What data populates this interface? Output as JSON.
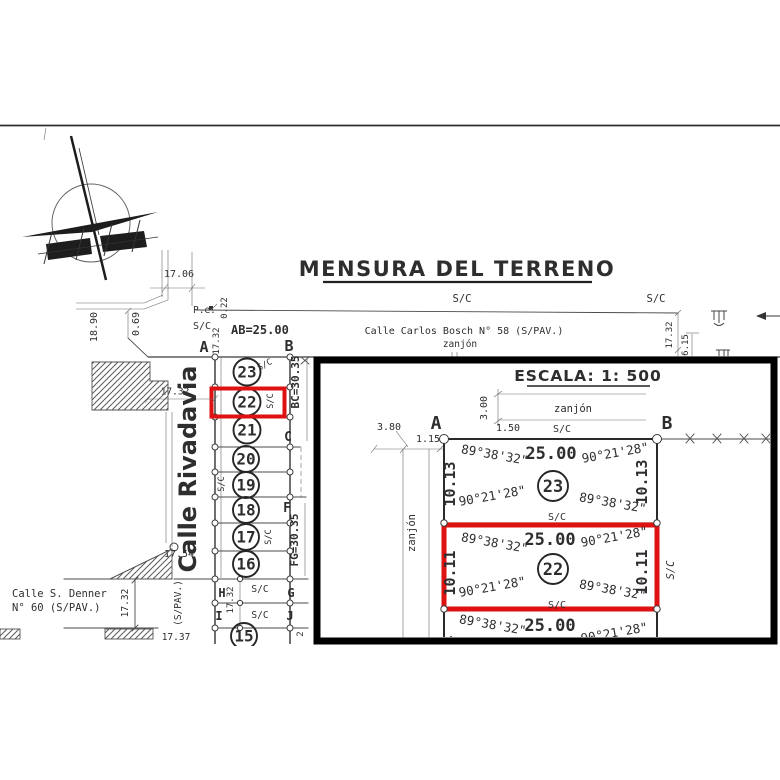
{
  "title": "MENSURA DEL TERRENO",
  "common": {
    "sc": "S/C",
    "zanjon": "zanjón"
  },
  "streets": {
    "carlos_bosch": "Calle Carlos Bosch N° 58 (S/PAV.)",
    "rivadavia": "Calle Rivadavia",
    "denner_line1": "Calle S. Denner",
    "denner_line2": "N° 60 (S/PAV.)",
    "spav_vertical": "(S/PAV.)",
    "pe": "P.e."
  },
  "dims": {
    "d1706": "17.06",
    "d1890": "18.90",
    "d069": "0.69",
    "d022": "0.22",
    "d1732": "17.32",
    "d615": "6.15",
    "d1754": "17.54",
    "d1737": "17.37",
    "d2": "2"
  },
  "blocks": {
    "ab": "AB=25.00",
    "bc": "BC=30.35",
    "fg": "FG=30.35"
  },
  "corners": {
    "a": "A",
    "b": "B",
    "c": "C",
    "f": "F",
    "g": "G",
    "h": "H",
    "i": "I",
    "j": "J"
  },
  "lots": {
    "n23": "23",
    "n22": "22",
    "n21": "21",
    "n20": "20",
    "n19": "19",
    "n18": "18",
    "n17": "17",
    "n16": "16",
    "n15": "15"
  },
  "inset": {
    "escala": "ESCALA: 1: 500",
    "d380": "3.80",
    "d115": "1.15",
    "d150": "1.50",
    "d300": "3.00",
    "len": "25.00",
    "side23": "10.13",
    "side22": "10.11",
    "side21": "10.11",
    "ang1": "89°38'32\"",
    "ang2": "90°21'28\""
  },
  "icons": {
    "north_arrow": "north-arrow-icon",
    "culvert": "culvert-icon",
    "flow_arrow": "flow-arrow-icon"
  },
  "colors": {
    "highlight": "#de1211",
    "ink": "#2e2e2e",
    "scan_line": "#4a4a4a"
  }
}
